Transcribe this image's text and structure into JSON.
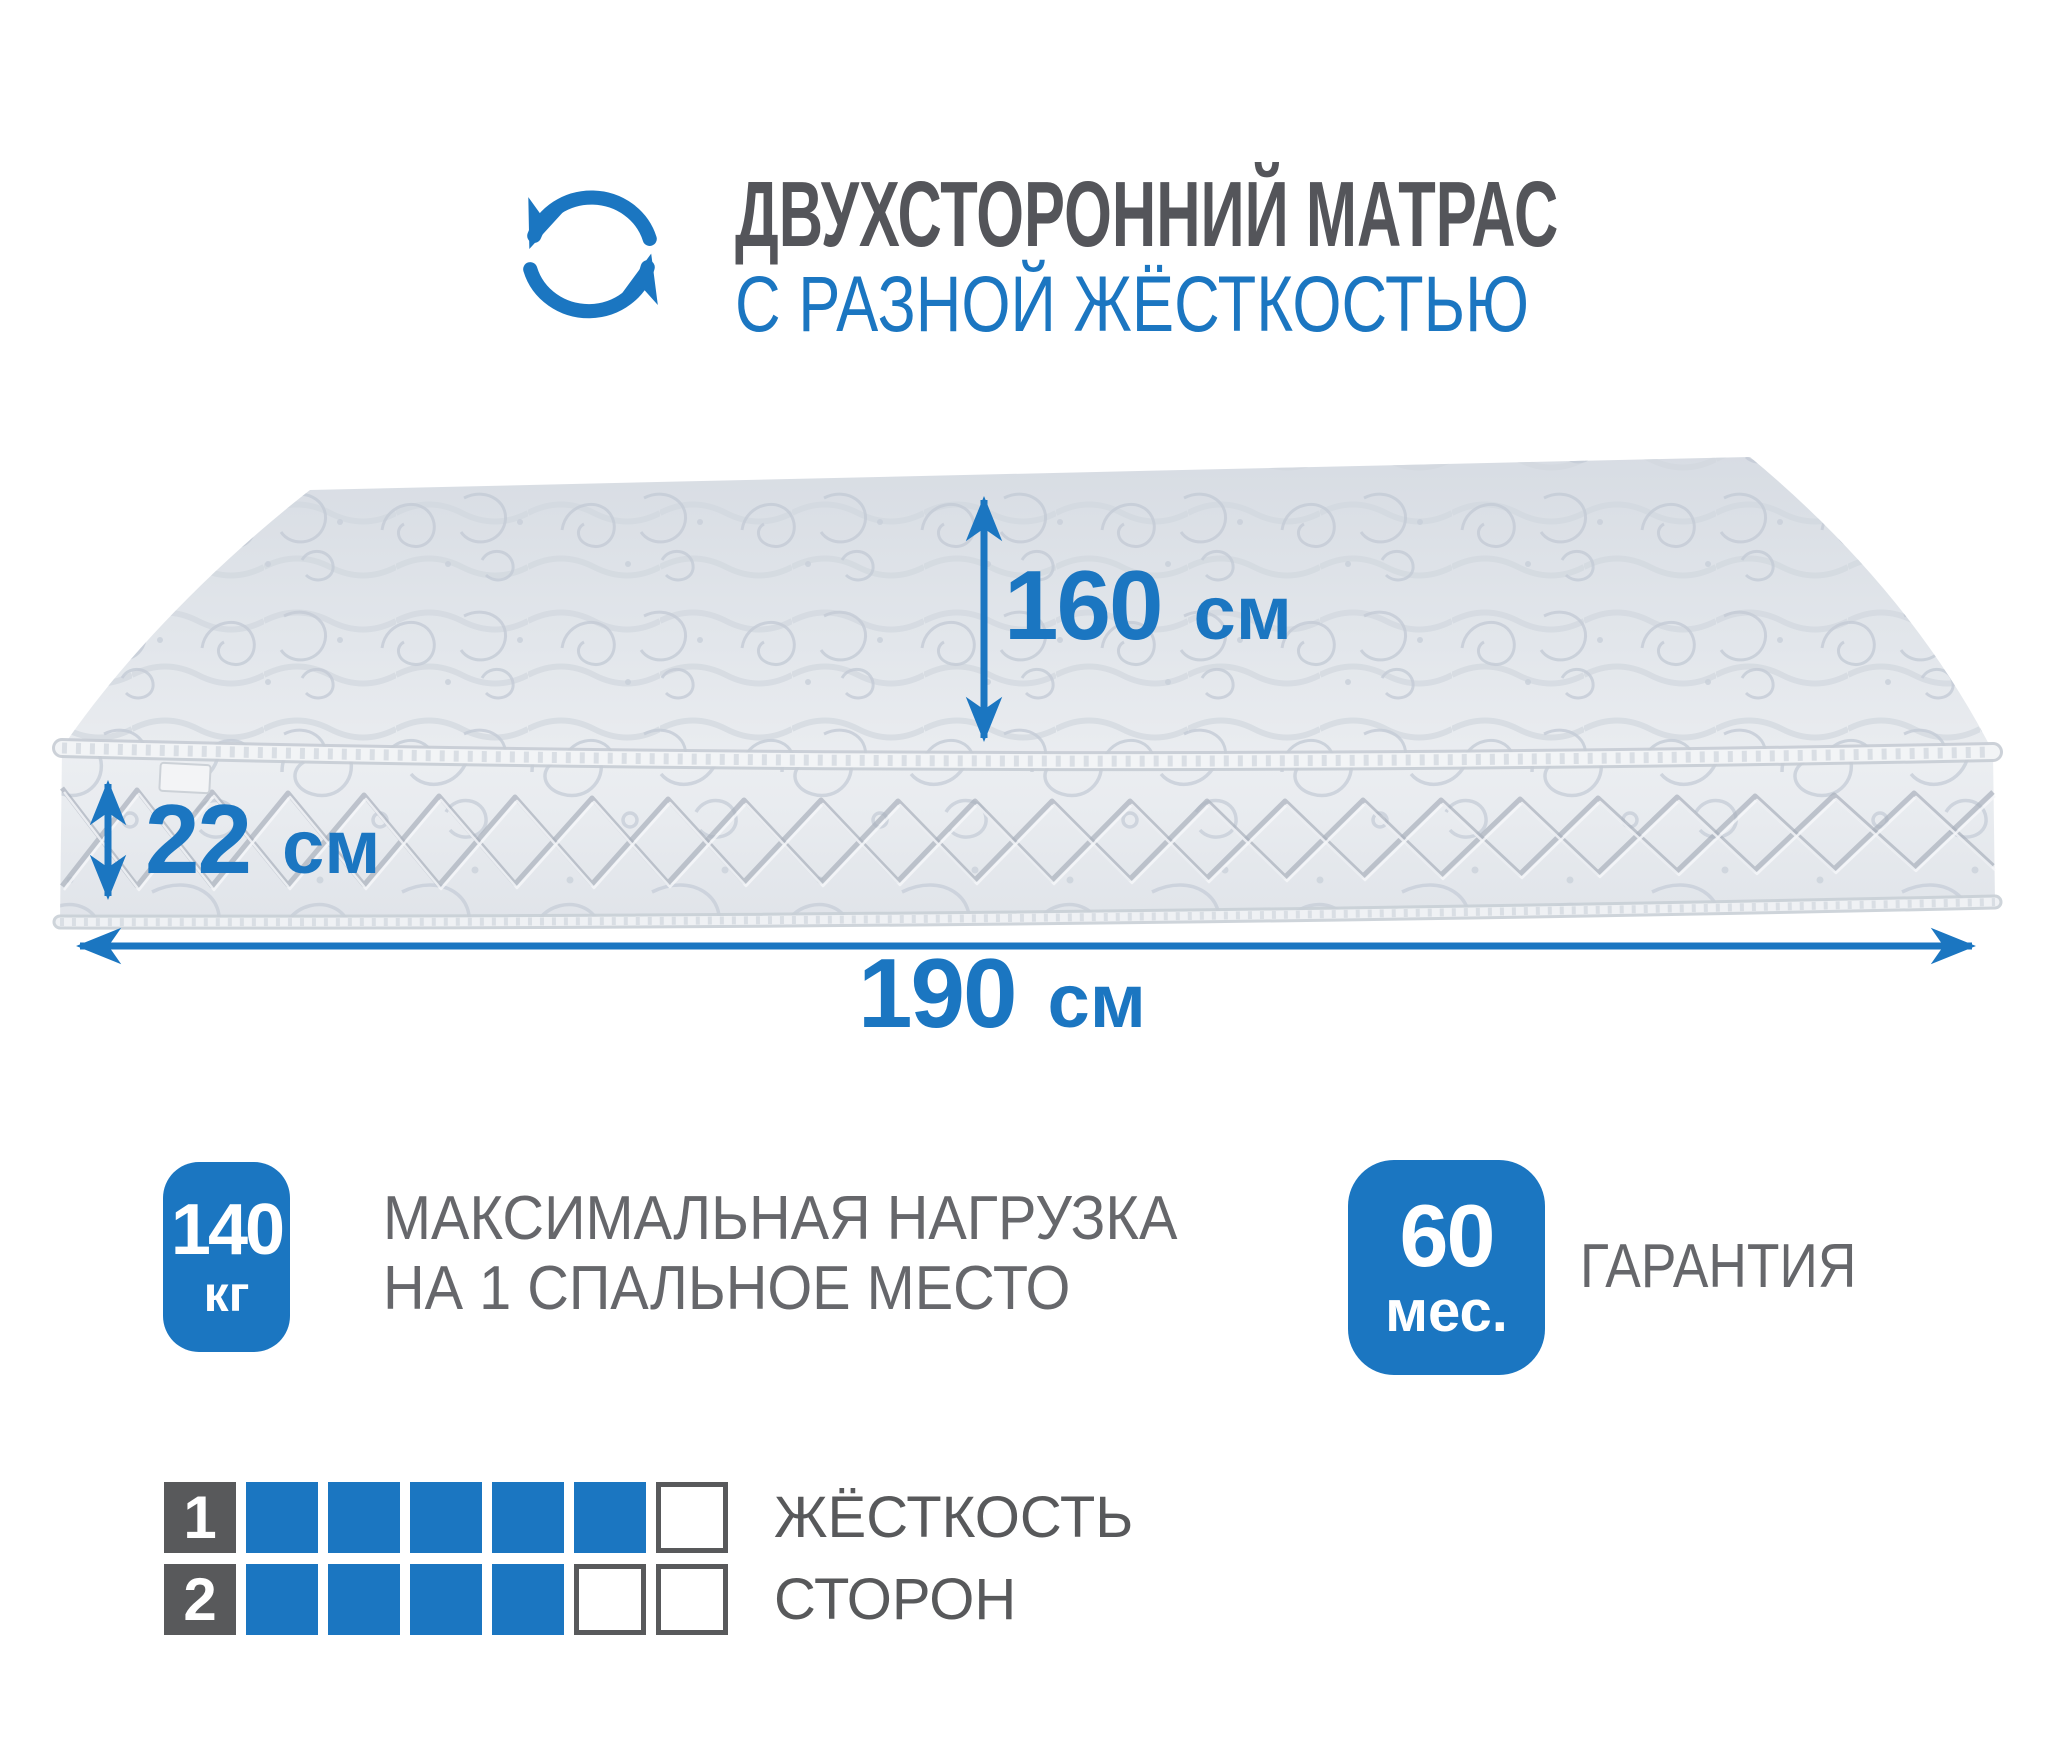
{
  "header": {
    "title": "ДВУХСТОРОННИЙ МАТРАС",
    "subtitle": "С РАЗНОЙ ЖЁСТКОСТЬЮ",
    "icon": "rotate-arrows-icon"
  },
  "dimensions": {
    "width": {
      "value": "160",
      "unit": "см"
    },
    "height": {
      "value": "22",
      "unit": "см"
    },
    "length": {
      "value": "190",
      "unit": "см"
    }
  },
  "badges": [
    {
      "value": "140",
      "unit": "кг",
      "caption_lines": [
        "МАКСИМАЛЬНАЯ НАГРУЗКА",
        "НА 1 СПАЛЬНОЕ МЕСТО"
      ]
    },
    {
      "value": "60",
      "unit": "мес.",
      "caption_lines": [
        "ГАРАНТИЯ"
      ]
    }
  ],
  "firmness": {
    "rows": [
      {
        "label": "1",
        "filled": 5,
        "total": 6,
        "caption": "ЖЁСТКОСТЬ"
      },
      {
        "label": "2",
        "filled": 4,
        "total": 6,
        "caption": "СТОРОН"
      }
    ]
  },
  "colors": {
    "blue": "#1b76c1",
    "dark_gray": "#58595b",
    "title_gray": "#54555a",
    "caption_gray": "#66676b"
  }
}
